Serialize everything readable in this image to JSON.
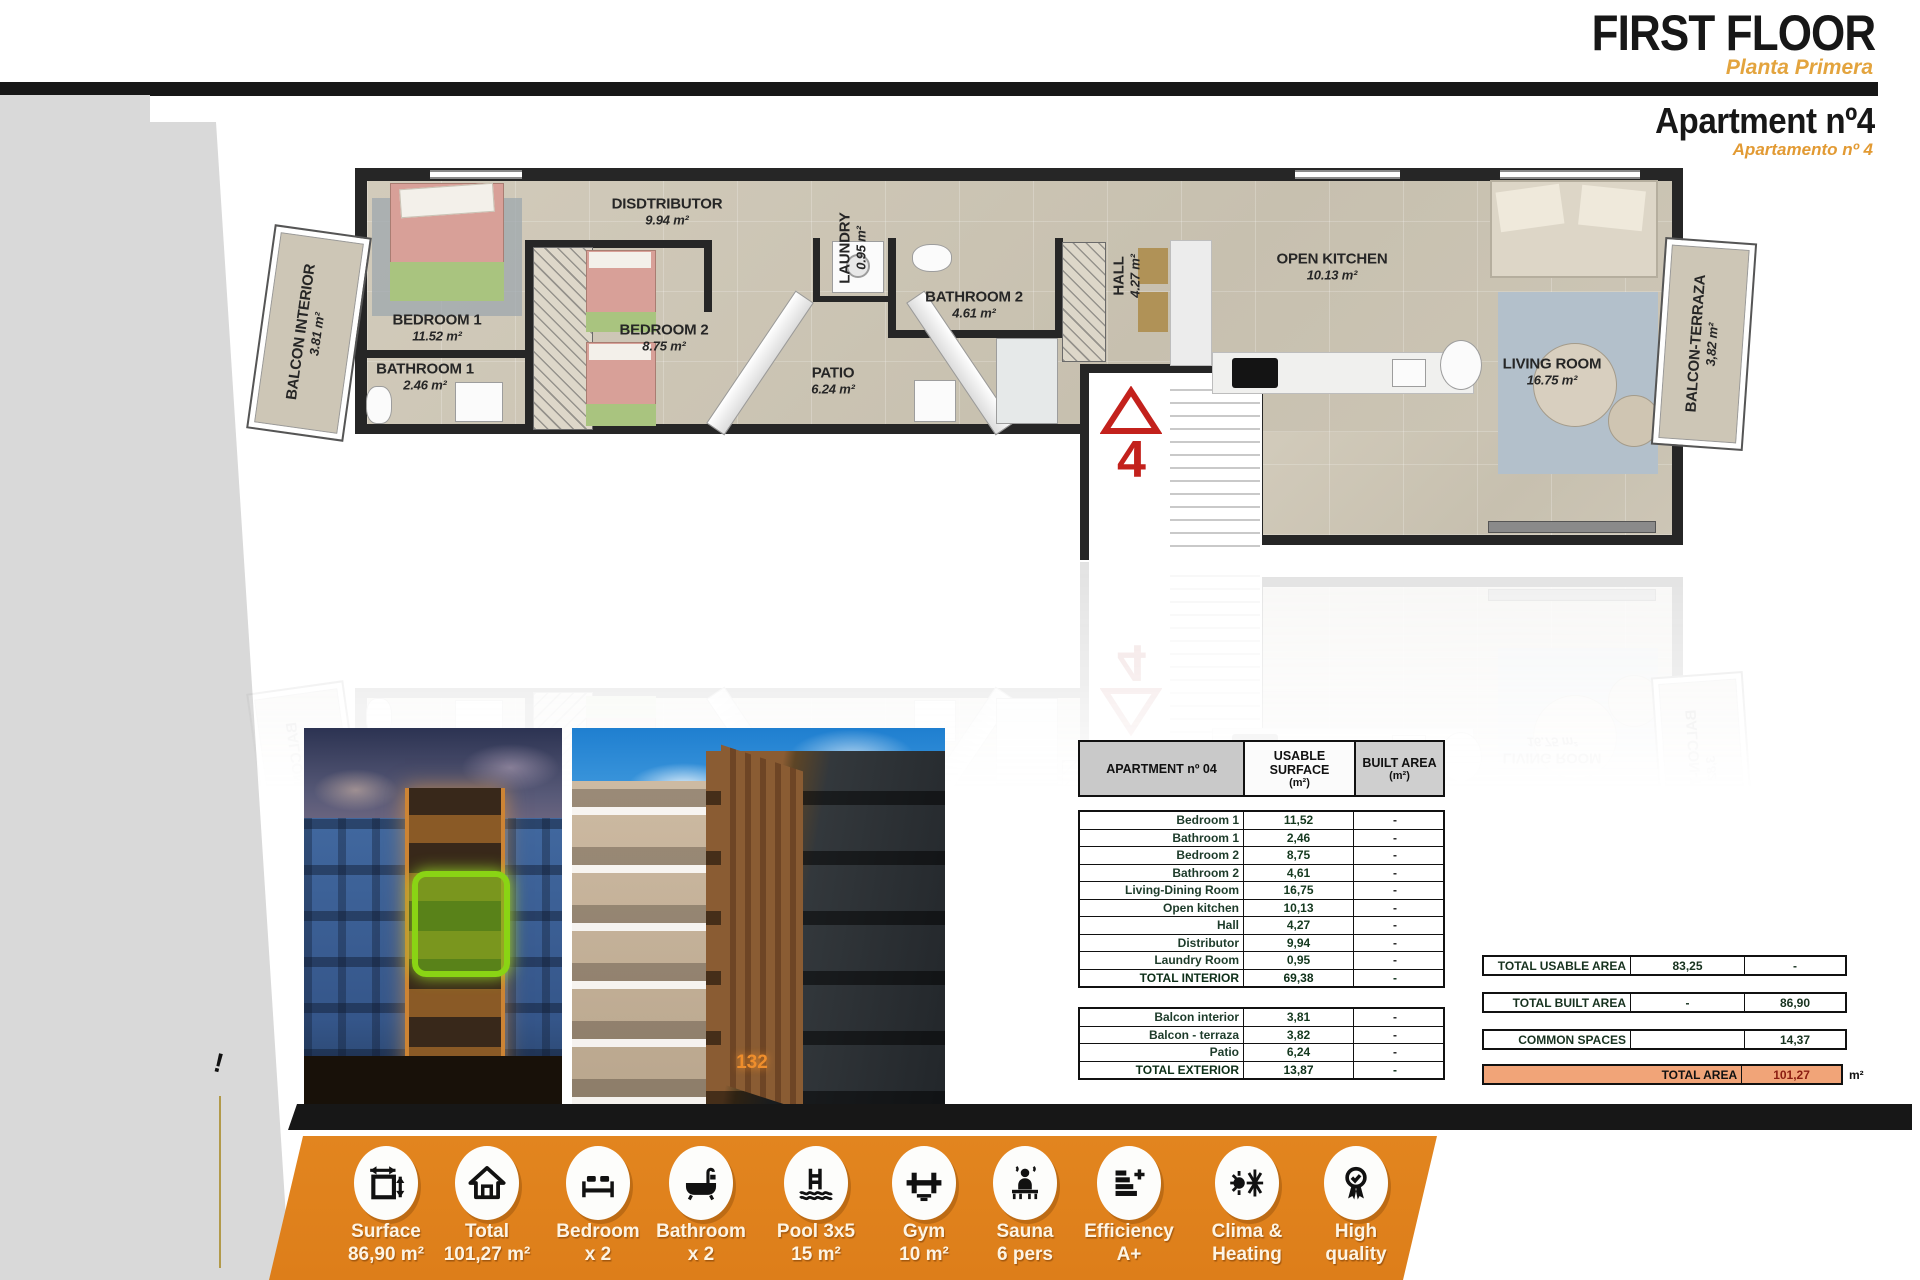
{
  "header": {
    "title": "FIRST FLOOR",
    "subtitle": "Planta Primera",
    "apartment_title": "Apartment nº4",
    "apartment_subtitle": "Apartamento nº 4"
  },
  "floor_plan": {
    "unit_marker": "4",
    "rooms": [
      {
        "name": "BEDROOM 1",
        "area": "11.52 m²"
      },
      {
        "name": "BATHROOM 1",
        "area": "2.46 m²"
      },
      {
        "name": "BEDROOM 2",
        "area": "8.75 m²"
      },
      {
        "name": "DISDTRIBUTOR",
        "area": "9.94 m²"
      },
      {
        "name": "LAUNDRY",
        "area": "0.95 m²"
      },
      {
        "name": "PATIO",
        "area": "6.24 m²"
      },
      {
        "name": "BATHROOM 2",
        "area": "4.61 m²"
      },
      {
        "name": "HALL",
        "area": "4.27 m²"
      },
      {
        "name": "OPEN KITCHEN",
        "area": "10.13 m²"
      },
      {
        "name": "LIVING ROOM",
        "area": "16.75 m²"
      },
      {
        "name": "BALCON INTERIOR",
        "area": "3.81 m²"
      },
      {
        "name": "BALCON-TERRAZA",
        "area": "3,82 m²"
      }
    ]
  },
  "photos": {
    "building_number": "132"
  },
  "surface_table": {
    "header": [
      {
        "title": "APARTMENT nº 04",
        "sub": ""
      },
      {
        "title": "USABLE SURFACE",
        "sub": "(m²)"
      },
      {
        "title": "BUILT AREA",
        "sub": "(m²)"
      }
    ],
    "interior_rows": [
      {
        "label": "Bedroom 1",
        "usable": "11,52",
        "built": "-"
      },
      {
        "label": "Bathroom 1",
        "usable": "2,46",
        "built": "-"
      },
      {
        "label": "Bedroom 2",
        "usable": "8,75",
        "built": "-"
      },
      {
        "label": "Bathroom 2",
        "usable": "4,61",
        "built": "-"
      },
      {
        "label": "Living-Dining Room",
        "usable": "16,75",
        "built": "-"
      },
      {
        "label": "Open kitchen",
        "usable": "10,13",
        "built": "-"
      },
      {
        "label": "Hall",
        "usable": "4,27",
        "built": "-"
      },
      {
        "label": "Distributor",
        "usable": "9,94",
        "built": "-"
      },
      {
        "label": "Laundry Room",
        "usable": "0,95",
        "built": "-"
      },
      {
        "label": "TOTAL INTERIOR",
        "usable": "69,38",
        "built": "-"
      }
    ],
    "exterior_rows": [
      {
        "label": "Balcon interior",
        "usable": "3,81",
        "built": "-"
      },
      {
        "label": "Balcon - terraza",
        "usable": "3,82",
        "built": "-"
      },
      {
        "label": "Patio",
        "usable": "6,24",
        "built": "-"
      },
      {
        "label": "TOTAL EXTERIOR",
        "usable": "13,87",
        "built": "-"
      }
    ]
  },
  "totals": {
    "rows": [
      {
        "label": "TOTAL USABLE AREA",
        "usable": "83,25",
        "built": "-"
      },
      {
        "label": "TOTAL BUILT AREA",
        "usable": "-",
        "built": "86,90"
      },
      {
        "label": "COMMON SPACES",
        "usable": "",
        "built": "14,37"
      }
    ],
    "total_area": {
      "label": "TOTAL AREA",
      "value": "101,27",
      "unit": "m²"
    }
  },
  "features": [
    {
      "icon": "measure-icon",
      "line1": "Surface",
      "line2": "86,90 m²"
    },
    {
      "icon": "house-icon",
      "line1": "Total",
      "line2": "101,27 m²"
    },
    {
      "icon": "bed-icon",
      "line1": "Bedroom",
      "line2": "x 2"
    },
    {
      "icon": "bathtub-icon",
      "line1": "Bathroom",
      "line2": "x 2"
    },
    {
      "icon": "pool-ladder-icon",
      "line1": "Pool 3x5",
      "line2": "15 m²"
    },
    {
      "icon": "dumbbell-icon",
      "line1": "Gym",
      "line2": "10 m²"
    },
    {
      "icon": "sauna-icon",
      "line1": "Sauna",
      "line2": "6 pers"
    },
    {
      "icon": "efficiency-icon",
      "line1": "Efficiency",
      "line2": "A+"
    },
    {
      "icon": "sun-snowflake-icon",
      "line1": "Clima &",
      "line2": "Heating"
    },
    {
      "icon": "medal-icon",
      "line1": "High",
      "line2": "quality"
    }
  ],
  "colors": {
    "accent_orange": "#e2851f",
    "title_orange": "#e3a43e",
    "total_row_orange": "#f1a478",
    "marker_red": "#c3211c",
    "wall_black": "#262626",
    "floor_beige": "#cdc6b6"
  }
}
